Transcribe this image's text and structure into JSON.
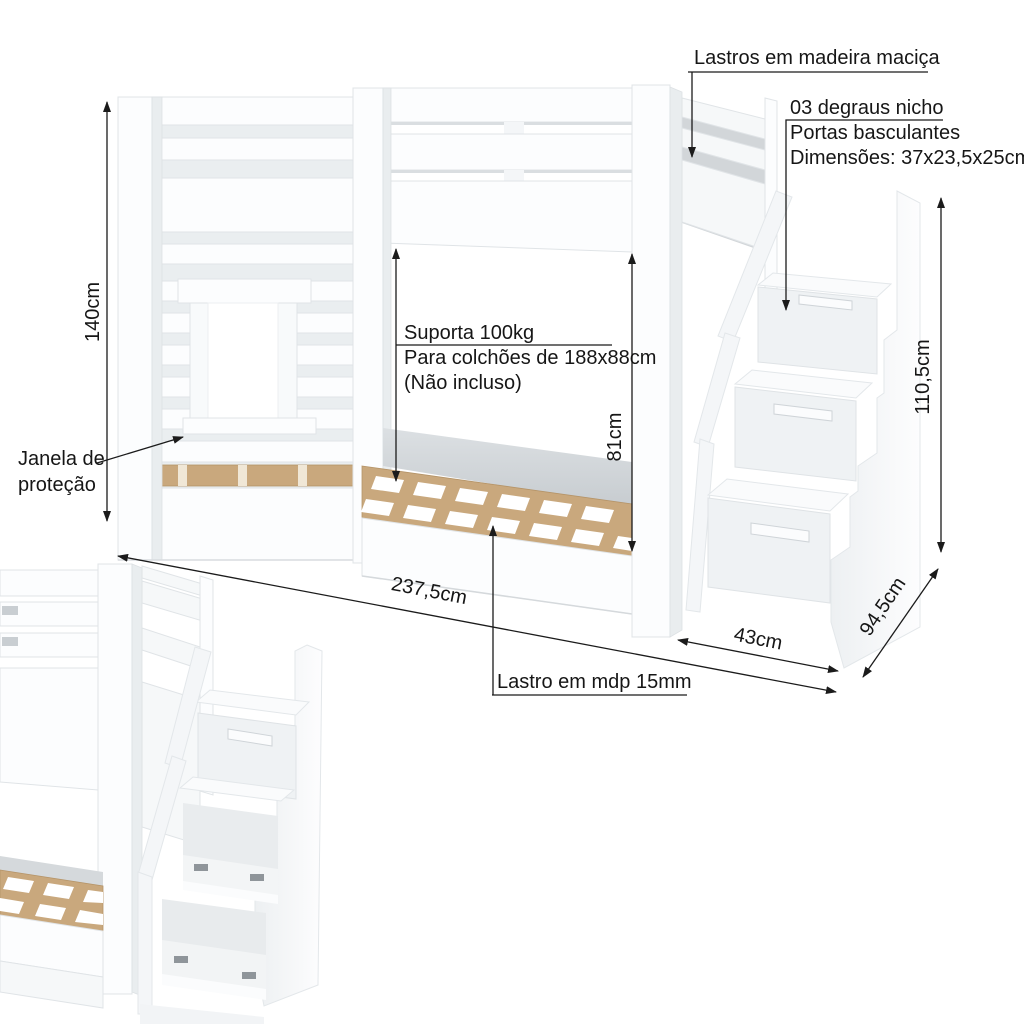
{
  "labels": {
    "lastros": "Lastros em madeira maciça",
    "steps": {
      "line1": "03 degraus nicho",
      "line2": "Portas basculantes",
      "line3": "Dimensões: 37x23,5x25cm"
    },
    "support": {
      "line1": "Suporta 100kg",
      "line2": "Para colchões de 188x88cm",
      "line3": "(Não incluso)"
    },
    "window": {
      "line1": "Janela de",
      "line2": "proteção"
    },
    "slats_mdp": "Lastro em mdp 15mm"
  },
  "dimensions": {
    "height_left": "140cm",
    "mattress_clearance": "81cm",
    "stair_height": "110,5cm",
    "stair_depth": "94,5cm",
    "stair_width": "43cm",
    "total_length": "237,5cm"
  },
  "colors": {
    "furniture_white": "#fcfdfe",
    "wood_slats": "#c9a87d",
    "dimension_line": "#1b1b1b",
    "background": "#ffffff"
  }
}
